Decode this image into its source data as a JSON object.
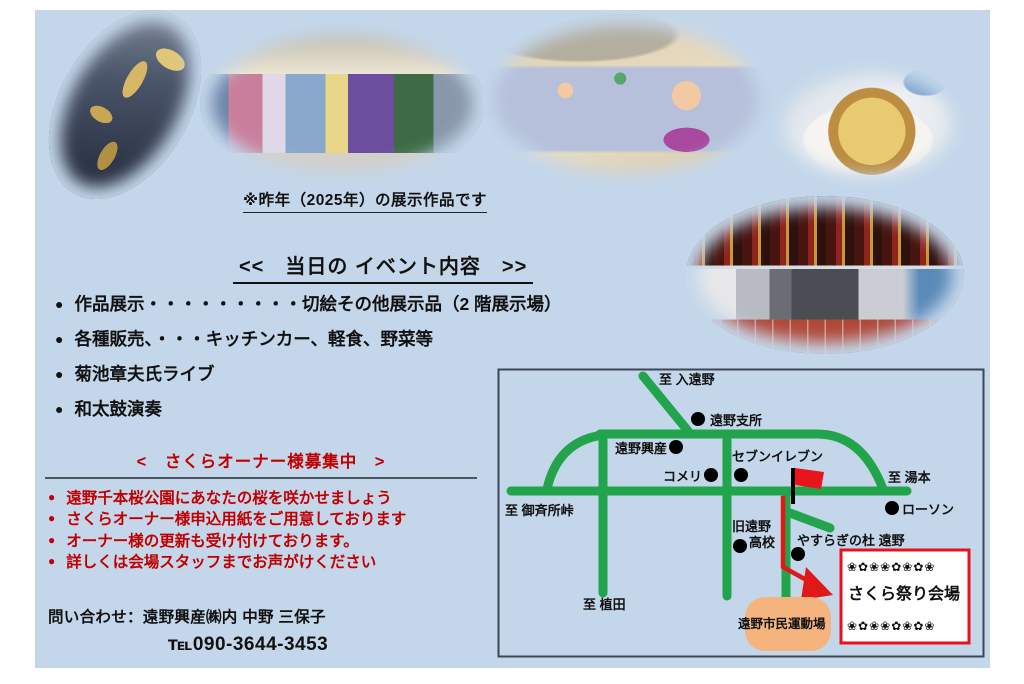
{
  "colors": {
    "page_bg": "#c4d7ea",
    "text_black": "#111111",
    "text_red": "#c00000",
    "road_green": "#21a44c",
    "route_red": "#e01818",
    "field_orange": "#f5b47e",
    "venue_border": "#e8121c",
    "sakura_pink": "#ef9fc4"
  },
  "photos": [
    {
      "id": "dragon-artwork-photo"
    },
    {
      "id": "gallery-hall-photo"
    },
    {
      "id": "kids-drawing-photo"
    },
    {
      "id": "pizza-photo"
    },
    {
      "id": "food-stall-photo"
    }
  ],
  "caption": "※昨年（2025年）の展示作品です",
  "event": {
    "heading": "<<　当日の イベント内容　>>",
    "marker": "●",
    "items": [
      "作品展示・・・・・・・・・切絵その他展示品（2 階展示場）",
      "各種販売、・・・キッチンカー、軽食、野菜等",
      "菊池章夫氏ライブ",
      "和太鼓演奏"
    ]
  },
  "recruit": {
    "heading": "<　さくらオーナー様募集中　>",
    "marker": "●",
    "items": [
      "遠野千本桜公園にあなたの桜を咲かせましょう",
      "さくらオーナー様申込用紙をご用意しております",
      "オーナー様の更新も受け付けております。",
      "詳しくは会場スタッフまでお声がけください"
    ]
  },
  "contact": {
    "line1": "問い合わせ：遠野興産㈱内 中野 三保子",
    "line2": "℡090-3644-3453"
  },
  "map": {
    "to_iritono": "至 入遠野",
    "tono_shisho": "遠野支所",
    "tono_kosan": "遠野興産",
    "seven_eleven": "セブンイレブン",
    "komeri": "コメリ",
    "to_yumoto": "至 湯本",
    "lawson": "ローソン",
    "to_gosaisho": "至 御斉所峠",
    "kyu_tono_line1": "旧遠野",
    "kyu_tono_line2": "高校",
    "yasuragi": "やすらぎの杜 遠野",
    "to_ueda": "至 植田",
    "undojo": "遠野市民運動場",
    "venue": "さくら祭り会場",
    "sakura_row": "❀✿❀❀✿❀✿❀"
  }
}
